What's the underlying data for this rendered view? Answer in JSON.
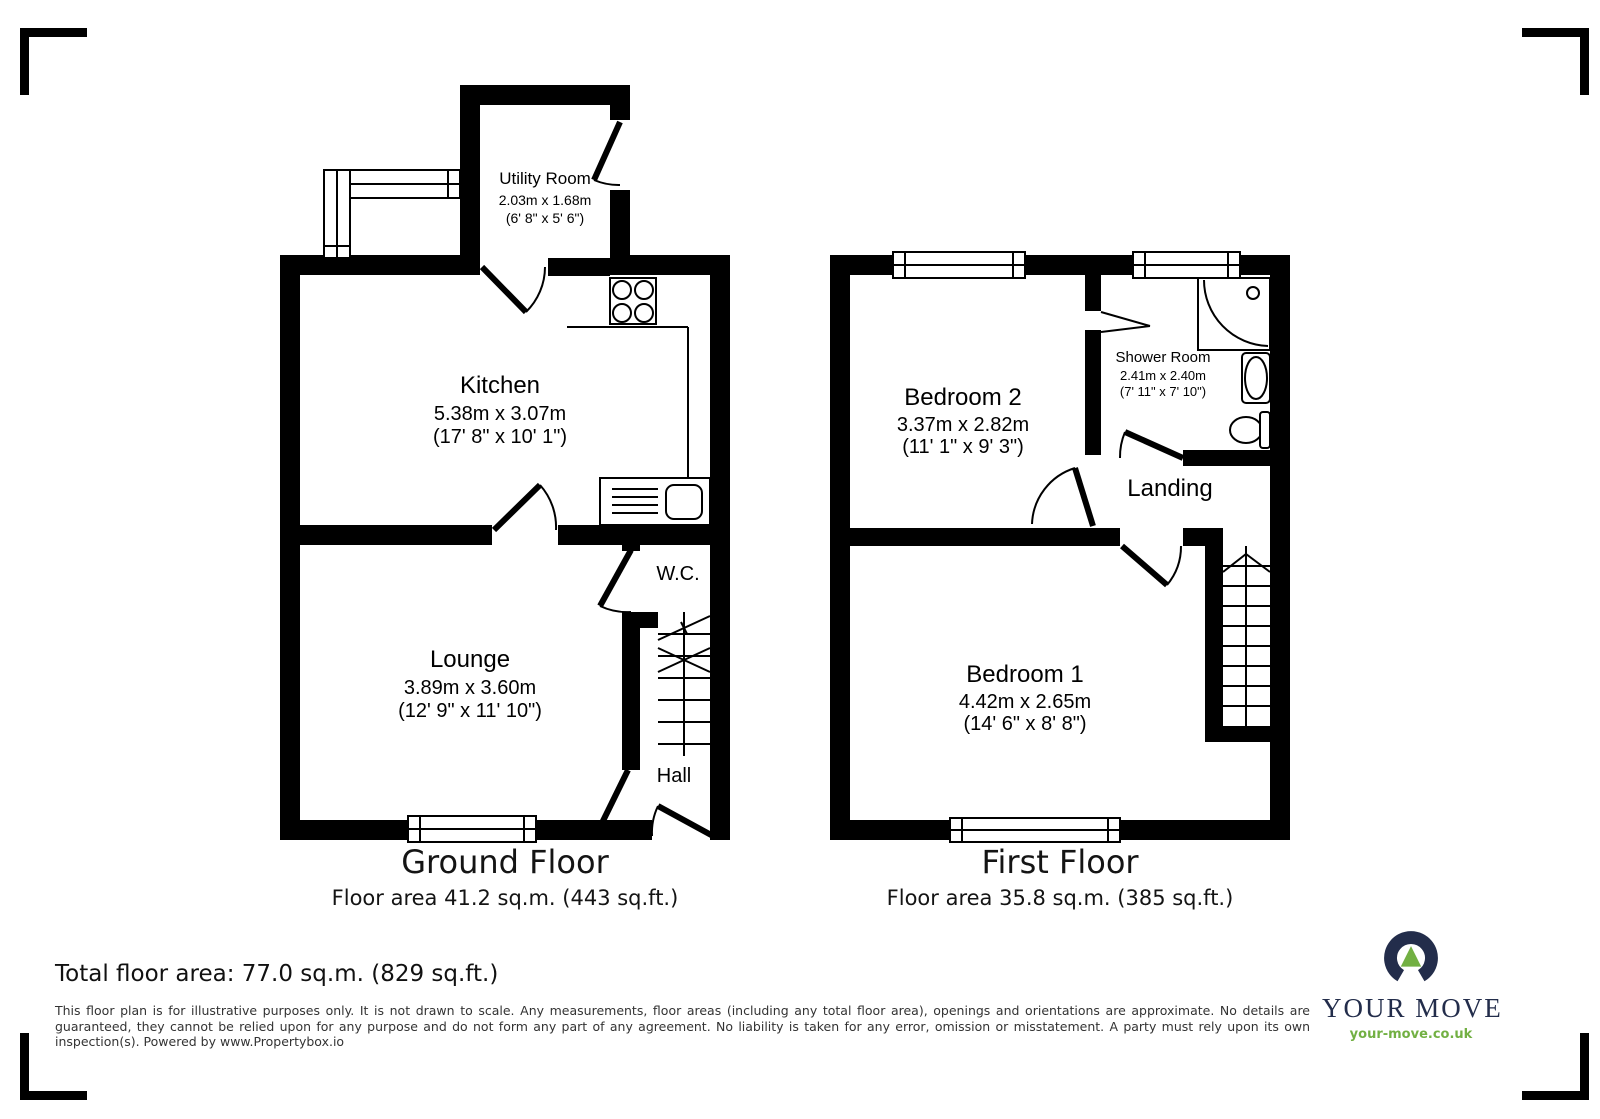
{
  "ground_floor": {
    "caption": {
      "title": "Ground Floor",
      "area": "Floor area 41.2 sq.m. (443 sq.ft.)"
    },
    "rooms": {
      "utility": {
        "name": "Utility Room",
        "metric": "2.03m x 1.68m",
        "imperial": "(6' 8\" x 5' 6\")"
      },
      "kitchen": {
        "name": "Kitchen",
        "metric": "5.38m x 3.07m",
        "imperial": "(17' 8\" x 10' 1\")"
      },
      "lounge": {
        "name": "Lounge",
        "metric": "3.89m x 3.60m",
        "imperial": "(12' 9\" x 11' 10\")"
      },
      "wc": {
        "name": "W.C."
      },
      "hall": {
        "name": "Hall"
      }
    }
  },
  "first_floor": {
    "caption": {
      "title": "First Floor",
      "area": "Floor area 35.8 sq.m. (385 sq.ft.)"
    },
    "rooms": {
      "bedroom2": {
        "name": "Bedroom 2",
        "metric": "3.37m x 2.82m",
        "imperial": "(11' 1\" x 9' 3\")"
      },
      "shower_room": {
        "name": "Shower Room",
        "metric": "2.41m x 2.40m",
        "imperial": "(7' 11\" x 7' 10\")"
      },
      "landing": {
        "name": "Landing"
      },
      "bedroom1": {
        "name": "Bedroom 1",
        "metric": "4.42m x 2.65m",
        "imperial": "(14' 6\" x 8' 8\")"
      }
    }
  },
  "summary": {
    "total_area": "Total floor area: 77.0 sq.m. (829 sq.ft.)"
  },
  "disclaimer": "This floor plan is for illustrative purposes only. It is not drawn to scale. Any measurements, floor areas (including any total floor area), openings and orientations are approximate. No details are guaranteed, they cannot be relied upon for any purpose and do not form any part of any agreement. No liability is taken for any error, omission or misstatement. A party must rely upon its own inspection(s). Powered by www.Propertybox.io",
  "logo": {
    "brand": "YOUR MOVE",
    "website": "your-move.co.uk",
    "colors": {
      "navy": "#232d4b",
      "green": "#72b043"
    }
  }
}
